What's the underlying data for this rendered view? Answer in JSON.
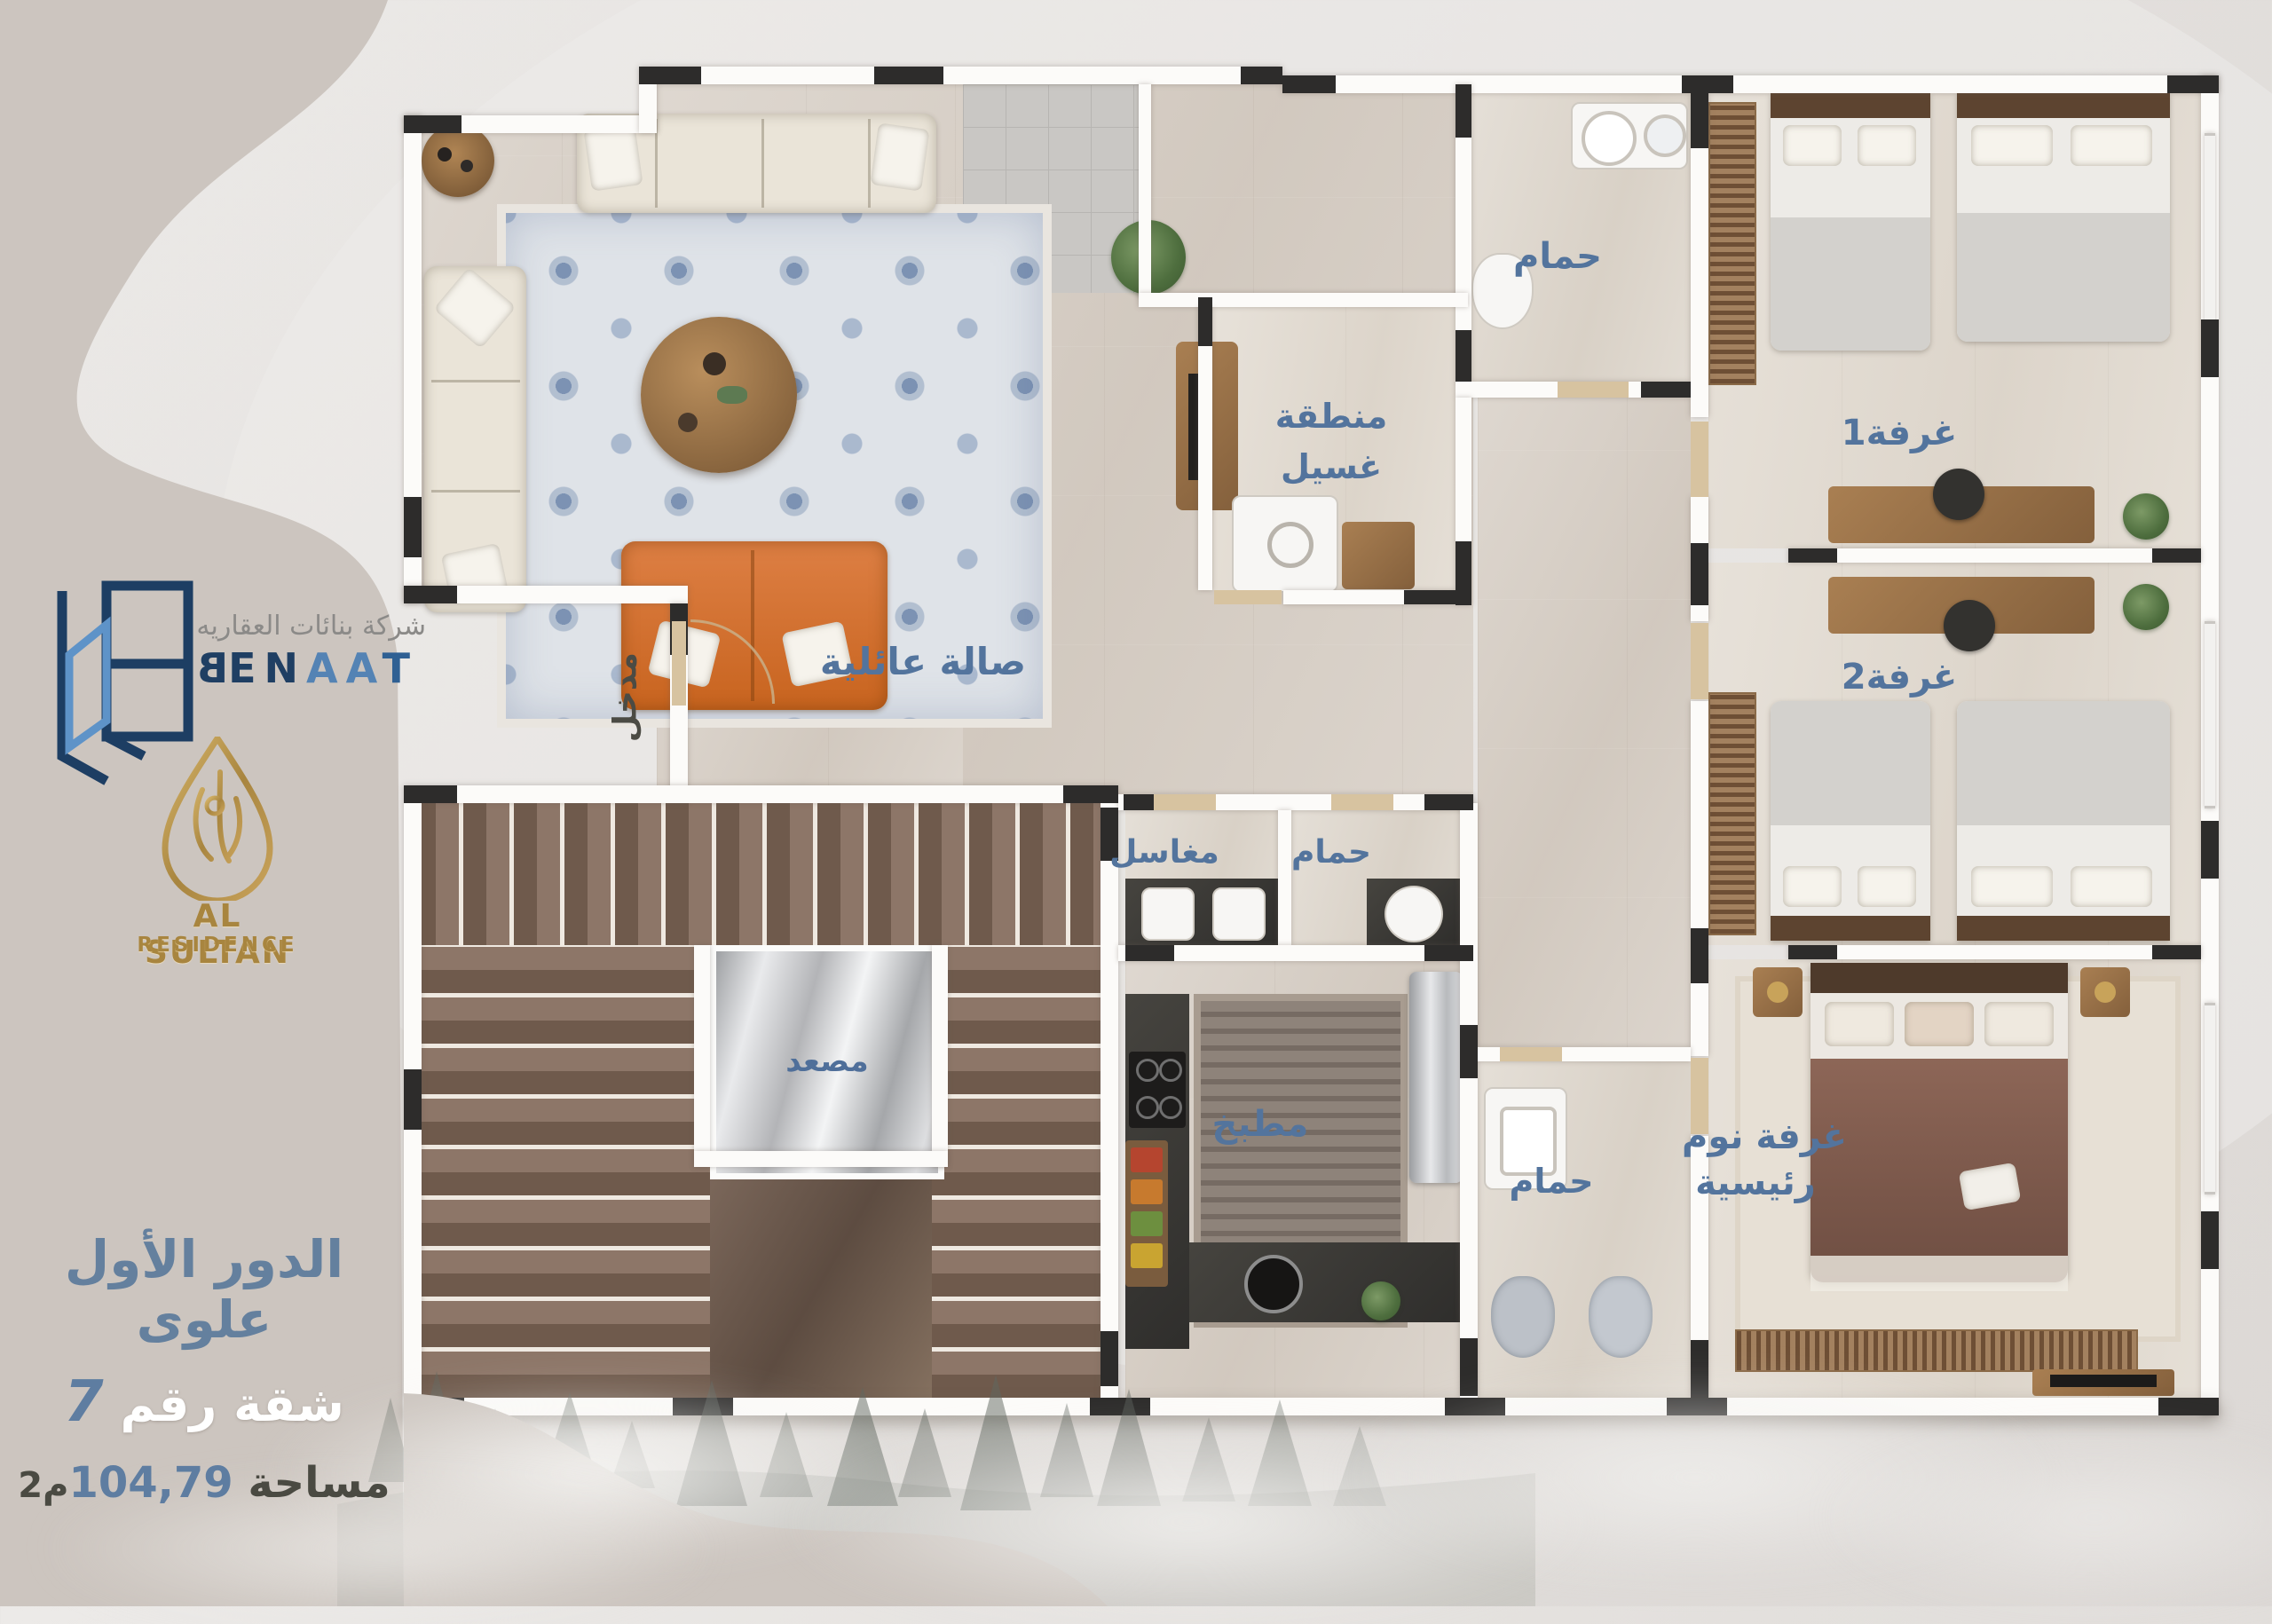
{
  "brand": {
    "name_ar": "شركة بنائات العقاريه",
    "en_b": "B",
    "en_mid": "EN",
    "en_aa": "AA",
    "en_t": "T",
    "sub_1": "AL SULTAN",
    "sub_2": "RESIDENCE"
  },
  "unit_info": {
    "floor_title": "الدور الأول علوى",
    "apartment_label": "شقة رقم",
    "apartment_number": "7",
    "area_label": "مساحة",
    "area_value": "104,79",
    "area_unit": "م2"
  },
  "rooms": {
    "family_hall": "صالة عائلية",
    "entrance": "مدخل",
    "laundry_line1": "منطقة",
    "laundry_line2": "غسيل",
    "bathroom_top": "حمام",
    "bathroom_mid": "حمام",
    "bathroom_bottom": "حمام",
    "sinks": "مغاسل",
    "bedroom1": "غرفة1",
    "bedroom2": "غرفة2",
    "master_line1": "غرفة نوم",
    "master_line2": "رئيسية",
    "kitchen": "مطبخ",
    "elevator": "مصعد"
  },
  "colors": {
    "label_blue": "#53749d",
    "title_blue": "#64809e",
    "navy": "#1f3f63",
    "steel_blue": "#5483b4",
    "gold": "#ab8a4c",
    "taupe_blob": "#ccc5bf",
    "dark_text": "#4b4b44",
    "wall_white": "#fcfbf9",
    "wall_black": "#2d2c2b",
    "floor_beige": "#d8d0c7"
  }
}
